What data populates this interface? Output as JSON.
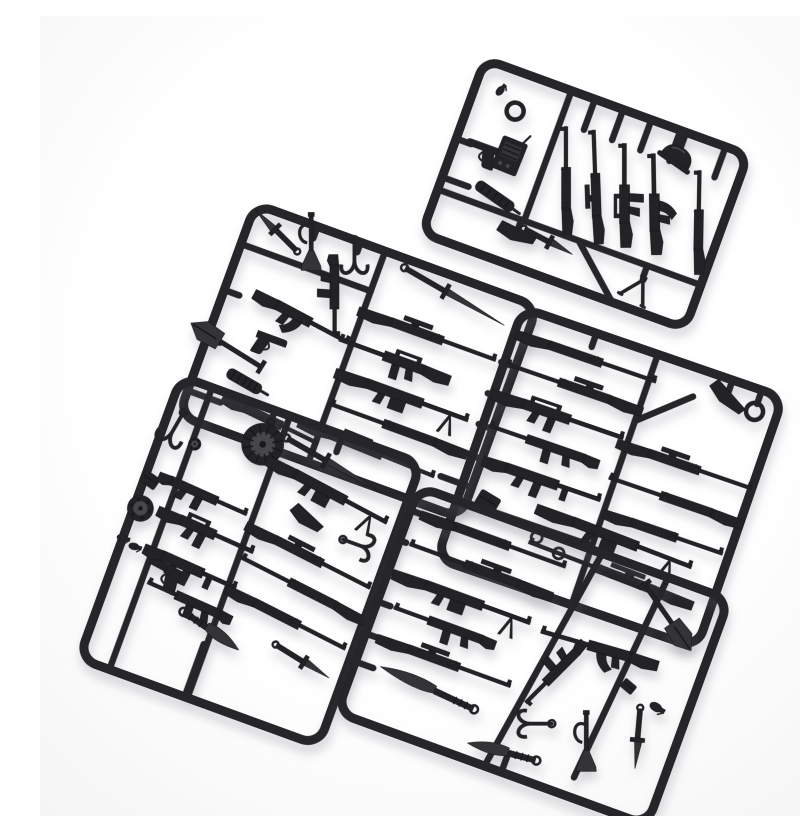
{
  "image": {
    "type": "product-photo",
    "description": "Five black plastic injection-molded sprues of miniature toy weapon parts (rifles, submachine guns, pistols, knives, swords, shovel, bugle, drum magazine, radio, hooks) photographed on a plain white background",
    "width": 800,
    "height": 800,
    "sprue_count": 5
  },
  "colors": {
    "background": "#fcfcfd",
    "plastic": "#232327",
    "plastic_mid": "#333338",
    "plastic_light": "#47474b",
    "frame": "#26262a",
    "dark_detail": "#18181a"
  },
  "sprues": [
    {
      "id": "sprue-top",
      "cx": 545,
      "cy": 178,
      "w": 280,
      "h": 185,
      "rotation": 20,
      "r": 16,
      "bars": [
        [
          -140,
          46,
          140,
          46
        ],
        [
          -48,
          -92,
          -48,
          46
        ],
        [
          -23,
          -92,
          -23,
          -60
        ],
        [
          7,
          -92,
          7,
          -60
        ],
        [
          37,
          -92,
          37,
          -60
        ],
        [
          68,
          -92,
          68,
          -60
        ],
        [
          116,
          -92,
          116,
          -60
        ],
        [
          74,
          -92,
          74,
          -74
        ],
        [
          -140,
          -8,
          -124,
          -8
        ],
        [
          -140,
          33,
          -112,
          33
        ],
        [
          10,
          46,
          62,
          92
        ],
        [
          -51,
          46,
          -51,
          58
        ],
        [
          83,
          46,
          83,
          58
        ]
      ],
      "items": [
        {
          "t": "grenade",
          "x": -115,
          "y": -68,
          "a": 20,
          "s": 0.9
        },
        {
          "t": "ring",
          "x": -94,
          "y": -54,
          "a": 0,
          "s": 1
        },
        {
          "t": "pistol",
          "x": -112,
          "y": -5,
          "a": 0,
          "f": 1
        },
        {
          "t": "radio",
          "x": -84,
          "y": -10,
          "a": 2
        },
        {
          "t": "suppressor",
          "x": -84,
          "y": 33,
          "a": 15,
          "l": 44
        },
        {
          "t": "stock-part",
          "x": -51,
          "y": 62,
          "a": 12,
          "l": 38
        },
        {
          "t": "knife",
          "x": -20,
          "y": 57,
          "a": 8,
          "l": 58
        },
        {
          "t": "bolt-rifle",
          "x": -23,
          "y": -8,
          "a": 250,
          "l": 112
        },
        {
          "t": "scoped-rifle",
          "x": 7,
          "y": -12,
          "a": 248,
          "l": 118
        },
        {
          "t": "assault-rifle",
          "x": 37,
          "y": -14,
          "a": 250,
          "l": 108
        },
        {
          "t": "ak-rifle",
          "x": 68,
          "y": -16,
          "a": 249,
          "l": 105
        },
        {
          "t": "helmet",
          "x": 74,
          "y": -66,
          "a": 15
        },
        {
          "t": "bolt-rifle",
          "x": 116,
          "y": -14,
          "a": 251,
          "l": 108
        },
        {
          "t": "bipod",
          "x": 83,
          "y": 66,
          "a": 10
        }
      ]
    },
    {
      "id": "sprue-mid-left",
      "cx": 318,
      "cy": 345,
      "w": 300,
      "h": 225,
      "rotation": 20,
      "r": 18,
      "bars": [
        [
          -12,
          -112,
          -12,
          112
        ],
        [
          -150,
          -70,
          -12,
          -70
        ],
        [
          -84,
          -112,
          -84,
          -100
        ],
        [
          -38,
          -112,
          -38,
          -102
        ],
        [
          -150,
          30,
          -136,
          30
        ],
        [
          -150,
          -21,
          -134,
          -21
        ],
        [
          135,
          -48,
          150,
          -48
        ],
        [
          133,
          -14,
          150,
          -14
        ],
        [
          135,
          18,
          150,
          18
        ],
        [
          137,
          50,
          150,
          50
        ],
        [
          117,
          80,
          150,
          80
        ],
        [
          -115,
          86,
          -150,
          86
        ]
      ],
      "items": [
        {
          "t": "knife",
          "x": -120,
          "y": -94,
          "a": 205,
          "l": 62
        },
        {
          "t": "trumpet",
          "x": -84,
          "y": -94,
          "a": 70,
          "l": 55
        },
        {
          "t": "hook",
          "x": -38,
          "y": -94,
          "a": 70,
          "l": 40
        },
        {
          "t": "smg",
          "x": -44,
          "y": -52,
          "a": 70,
          "l": 85
        },
        {
          "t": "ak-rifle",
          "x": -66,
          "y": -21,
          "a": 8,
          "l": 110
        },
        {
          "t": "pistol",
          "x": -89,
          "y": 13,
          "a": 0,
          "s": 0.95
        },
        {
          "t": "shovel",
          "x": -130,
          "y": 30,
          "a": 12,
          "f": 1,
          "l": 82
        },
        {
          "t": "suppressor",
          "x": -100,
          "y": 58,
          "a": 10,
          "l": 38
        },
        {
          "t": "sword",
          "x": 66,
          "y": -94,
          "a": 10,
          "l": 120
        },
        {
          "t": "scoped-rifle",
          "x": 58,
          "y": -48,
          "a": 0,
          "l": 150
        },
        {
          "t": "assault-rifle",
          "x": 32,
          "y": -14,
          "a": 0,
          "f": 1,
          "l": 122
        },
        {
          "t": "lmg",
          "x": 55,
          "y": 18,
          "a": 0,
          "l": 145
        },
        {
          "t": "bolt-rifle",
          "x": 60,
          "y": 50,
          "a": 0,
          "f": 1,
          "l": 150
        },
        {
          "t": "scoped-rifle",
          "x": 40,
          "y": 80,
          "a": 2,
          "l": 150
        },
        {
          "t": "bolt-rifle",
          "x": -60,
          "y": 86,
          "a": 6,
          "l": 110
        }
      ]
    },
    {
      "id": "sprue-mid-right",
      "cx": 570,
      "cy": 462,
      "w": 275,
      "h": 265,
      "rotation": 19,
      "r": 18,
      "bars": [
        [
          5,
          -132,
          5,
          132
        ],
        [
          -137,
          70,
          5,
          70
        ],
        [
          5,
          -62,
          52,
          -104
        ],
        [
          -60,
          -132,
          -60,
          -118
        ],
        [
          84,
          -132,
          84,
          -120
        ],
        [
          115,
          -132,
          115,
          -118
        ]
      ],
      "items": [
        {
          "t": "bolt-rifle",
          "x": -60,
          "y": -106,
          "a": 0,
          "l": 152
        },
        {
          "t": "scoped-rifle",
          "x": -65,
          "y": -74,
          "a": 0,
          "f": 1,
          "l": 148
        },
        {
          "t": "assault-rifle",
          "x": -68,
          "y": -42,
          "a": 0,
          "l": 143
        },
        {
          "t": "smg",
          "x": -75,
          "y": -10,
          "a": 0,
          "f": 1,
          "l": 120
        },
        {
          "t": "tommy-smg",
          "x": -62,
          "y": 24,
          "a": 0,
          "l": 128
        },
        {
          "t": "pouch",
          "x": -108,
          "y": 62,
          "a": 12
        },
        {
          "t": "ring",
          "x": -50,
          "y": 80,
          "a": 0,
          "s": 0.8
        },
        {
          "t": "ring",
          "x": -24,
          "y": 88,
          "a": 0,
          "s": 0.8
        },
        {
          "t": "lmg",
          "x": 25,
          "y": 55,
          "a": 2,
          "l": 170
        },
        {
          "t": "scoped-rifle",
          "x": 30,
          "y": 90,
          "a": 2,
          "f": 1,
          "l": 180
        },
        {
          "t": "stock-part",
          "x": 84,
          "y": -113,
          "a": 35,
          "l": 40
        },
        {
          "t": "ring",
          "x": 115,
          "y": -110,
          "a": 0,
          "s": 1
        },
        {
          "t": "scoped-rifle",
          "x": 68,
          "y": -36,
          "a": 0,
          "l": 146
        },
        {
          "t": "bolt-rifle",
          "x": 68,
          "y": 0,
          "a": 0,
          "f": 1,
          "l": 146
        },
        {
          "t": "bolt-rifle",
          "x": 70,
          "y": 35,
          "a": 0,
          "l": 130
        }
      ]
    },
    {
      "id": "sprue-bottom-left",
      "cx": 210,
      "cy": 545,
      "w": 255,
      "h": 300,
      "rotation": 20,
      "r": 18,
      "bars": [
        [
          -95,
          -150,
          -95,
          150
        ],
        [
          -12,
          -150,
          -12,
          150
        ],
        [
          -28,
          -150,
          -28,
          -136
        ],
        [
          -15,
          150,
          -15,
          94
        ],
        [
          44,
          -150,
          44,
          -132
        ]
      ],
      "items": [
        {
          "t": "hook",
          "x": -117,
          "y": -96,
          "a": 100,
          "l": 42
        },
        {
          "t": "pouch",
          "x": -122,
          "y": -42,
          "a": 15,
          "s": 0.9
        },
        {
          "t": "wheel",
          "x": -121,
          "y": -12,
          "a": 0,
          "s": 1
        },
        {
          "t": "grenade",
          "x": -128,
          "y": 22,
          "a": 85,
          "s": 0.9
        },
        {
          "t": "grenade",
          "x": -114,
          "y": 26,
          "a": 85,
          "s": 0.9
        },
        {
          "t": "pistol",
          "x": -76,
          "y": 40,
          "a": 8,
          "f": 1,
          "s": 1.1
        },
        {
          "t": "wheel",
          "x": -92,
          "y": -91,
          "a": 0,
          "s": 0.7
        },
        {
          "t": "drum-magazine",
          "x": -28,
          "y": -114,
          "a": 0,
          "s": 1
        },
        {
          "t": "smg",
          "x": -65,
          "y": -46,
          "a": 4,
          "l": 100
        },
        {
          "t": "assault-rifle",
          "x": -50,
          "y": -13,
          "a": 4,
          "l": 108
        },
        {
          "t": "tommy-smg",
          "x": -52,
          "y": 27,
          "a": 4,
          "l": 104
        },
        {
          "t": "smg",
          "x": -45,
          "y": 58,
          "a": 4,
          "f": 1,
          "l": 96
        },
        {
          "t": "machete",
          "x": -15,
          "y": 78,
          "a": 14,
          "l": 72
        },
        {
          "t": "sword",
          "x": 44,
          "y": -119,
          "a": 10,
          "l": 115
        },
        {
          "t": "lmg",
          "x": 50,
          "y": -92,
          "a": 8,
          "l": 140
        },
        {
          "t": "stock-part",
          "x": 38,
          "y": -58,
          "a": 30,
          "l": 34
        },
        {
          "t": "hook",
          "x": 98,
          "y": -52,
          "a": 0,
          "l": 36
        },
        {
          "t": "scoped-rifle",
          "x": 55,
          "y": -24,
          "a": 7,
          "l": 143
        },
        {
          "t": "bolt-rifle",
          "x": 58,
          "y": 8,
          "a": 7,
          "f": 1,
          "l": 143
        },
        {
          "t": "bolt-rifle",
          "x": 55,
          "y": 42,
          "a": 7,
          "l": 138
        },
        {
          "t": "knife",
          "x": 82,
          "y": 76,
          "a": 12,
          "l": 66
        }
      ]
    },
    {
      "id": "sprue-bottom-right",
      "cx": 493,
      "cy": 640,
      "w": 330,
      "h": 240,
      "rotation": 20,
      "r": 18,
      "bars": [
        [
          30,
          -120,
          -8,
          120
        ],
        [
          100,
          -120,
          80,
          100
        ],
        [
          -165,
          66,
          -146,
          66
        ],
        [
          10,
          120,
          10,
          104
        ],
        [
          -165,
          -95,
          -155,
          -95
        ],
        [
          -165,
          -63,
          -158,
          -63
        ],
        [
          -165,
          -30,
          -160,
          -30
        ],
        [
          -165,
          2,
          -151,
          2
        ],
        [
          -165,
          36,
          -154,
          36
        ]
      ],
      "items": [
        {
          "t": "bolt-rifle",
          "x": -75,
          "y": -95,
          "a": 0,
          "l": 158
        },
        {
          "t": "scoped-rifle",
          "x": -80,
          "y": -63,
          "a": 0,
          "f": 1,
          "l": 156
        },
        {
          "t": "lmg",
          "x": -85,
          "y": -30,
          "a": 0,
          "l": 150
        },
        {
          "t": "smg",
          "x": -95,
          "y": 2,
          "a": 0,
          "f": 1,
          "l": 112
        },
        {
          "t": "scoped-rifle",
          "x": -80,
          "y": 36,
          "a": 0,
          "l": 146
        },
        {
          "t": "machete",
          "x": -86,
          "y": 66,
          "a": 5,
          "f": 1,
          "l": 108
        },
        {
          "t": "machete",
          "x": 6,
          "y": 100,
          "a": -5,
          "f": 1,
          "l": 76
        },
        {
          "t": "smg",
          "x": 26,
          "y": 10,
          "a": 115,
          "l": 88
        },
        {
          "t": "ak-rifle",
          "x": 58,
          "y": -30,
          "a": -4,
          "f": 1,
          "l": 126
        },
        {
          "t": "shovel",
          "x": 114,
          "y": -82,
          "a": 35,
          "l": 80
        },
        {
          "t": "hook",
          "x": 22,
          "y": 64,
          "a": 160,
          "l": 40
        },
        {
          "t": "trumpet",
          "x": 80,
          "y": 64,
          "a": 70,
          "l": 58
        },
        {
          "t": "knife",
          "x": 126,
          "y": 40,
          "a": 75,
          "l": 64
        },
        {
          "t": "pouch",
          "x": 100,
          "y": -4,
          "a": 20,
          "s": 0.8
        },
        {
          "t": "grenade",
          "x": 133,
          "y": 6,
          "a": 100
        }
      ]
    }
  ]
}
